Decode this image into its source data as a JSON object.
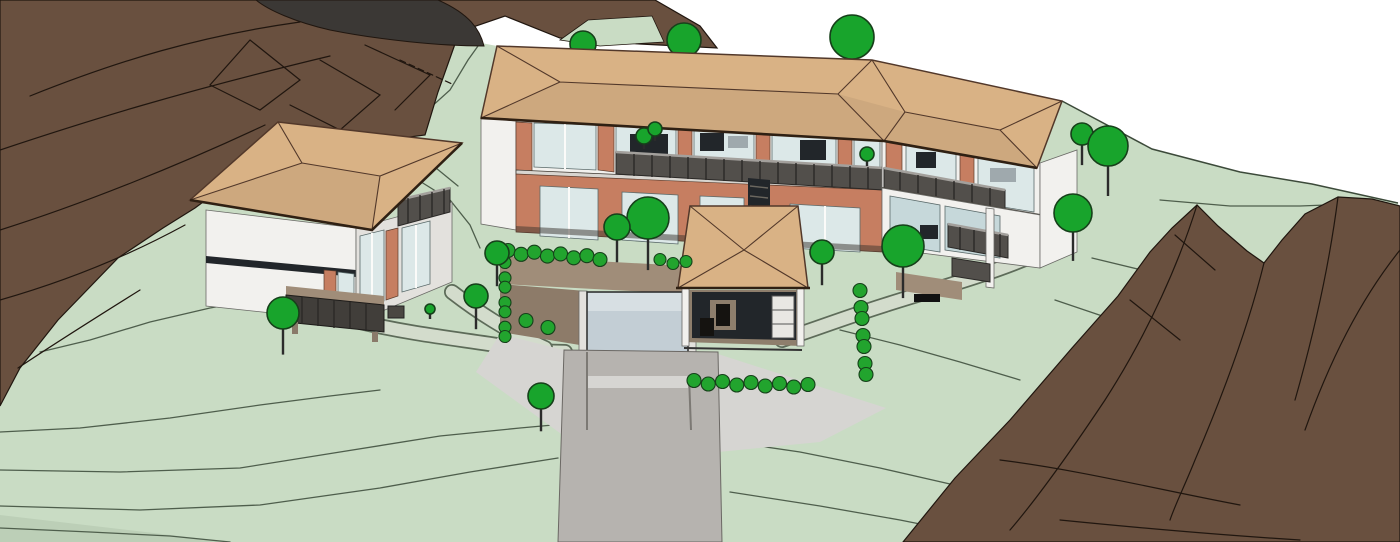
{
  "scene": {
    "type": "architectural-3d-site-view",
    "description": "Shaded 3D site model of a hillside estate: a two-storey villa with hipped roof on the left, a long main residence with continuous balcony and hipped roof in the centre, a small garden pavilion, a sunken glazed courtyard with concrete driveway ramp, terraced lawns with contour lines, round trees and hedges, and brown rocky slopes left and right under a white sky."
  },
  "colors": {
    "sky": "#ffffff",
    "grass": "#c9dcc4",
    "grass_dark": "#bccfb7",
    "horizon": "#3c4a3a",
    "contour_grass": "#4e5e4c",
    "path_fill": "#d3dccc",
    "path_edge": "#5d6b59",
    "hill_brown": "#69503f",
    "hill_outline": "#20160f",
    "charcoal": "#3b3835",
    "roof_tan": "#d9b285",
    "roof_line": "#52382a",
    "roof_dark": "#2f2013",
    "wall_white": "#f2f1ee",
    "wall_shade": "#e3e1dd",
    "terracotta": "#c67e61",
    "glass": "#dce8e8",
    "glass_shade": "#c6d8da",
    "interior_gray": "#9fa9ad",
    "interior_dark": "#22262a",
    "railing": "#524f4b",
    "railing_dark": "#2b2927",
    "railing_top": "#a3a09c",
    "deck_taupe": "#a08d79",
    "deck_shadow": "#8d7b69",
    "deck_front": "#413e3a",
    "concrete": "#b6b3af",
    "concrete_light": "#d6d5d2",
    "ramp_glass": "#c3ced5",
    "ramp_glass_light": "#d7dfe3",
    "tree_fill": "#18a42c",
    "tree_stroke": "#16401a",
    "trunk": "#2b2b2b",
    "hedge_fill": "#22a42e"
  },
  "trees": {
    "background": [
      {
        "x": 583,
        "y": 44,
        "r": 13
      },
      {
        "x": 684,
        "y": 40,
        "r": 17
      },
      {
        "x": 852,
        "y": 37,
        "r": 22
      }
    ],
    "foreground": [
      {
        "x": 1082,
        "y": 134,
        "r": 11
      },
      {
        "x": 1108,
        "y": 146,
        "r": 20
      },
      {
        "x": 1073,
        "y": 213,
        "r": 19
      },
      {
        "x": 903,
        "y": 246,
        "r": 21
      },
      {
        "x": 822,
        "y": 252,
        "r": 12
      },
      {
        "x": 648,
        "y": 218,
        "r": 21
      },
      {
        "x": 617,
        "y": 227,
        "r": 13
      },
      {
        "x": 497,
        "y": 253,
        "r": 12
      },
      {
        "x": 476,
        "y": 296,
        "r": 12
      },
      {
        "x": 283,
        "y": 313,
        "r": 16
      },
      {
        "x": 541,
        "y": 396,
        "r": 13
      }
    ],
    "planters": [
      {
        "x": 644,
        "y": 136,
        "r": 8
      },
      {
        "x": 655,
        "y": 129,
        "r": 7
      },
      {
        "x": 867,
        "y": 154,
        "r": 7
      },
      {
        "x": 430,
        "y": 309,
        "r": 5
      }
    ]
  },
  "hedgerows": [
    {
      "x1": 508,
      "y1": 252,
      "x2": 600,
      "y2": 258,
      "r": 7,
      "n": 8
    },
    {
      "x1": 660,
      "y1": 261,
      "x2": 686,
      "y2": 263,
      "r": 6,
      "n": 3
    },
    {
      "x1": 694,
      "y1": 382,
      "x2": 808,
      "y2": 386,
      "r": 7,
      "n": 9
    },
    {
      "x1": 505,
      "y1": 264,
      "x2": 505,
      "y2": 338,
      "r": 6,
      "n": 7
    },
    {
      "x1": 860,
      "y1": 292,
      "x2": 866,
      "y2": 376,
      "r": 7,
      "n": 7
    },
    {
      "x1": 526,
      "y1": 322,
      "x2": 548,
      "y2": 326,
      "r": 7,
      "n": 2
    }
  ]
}
